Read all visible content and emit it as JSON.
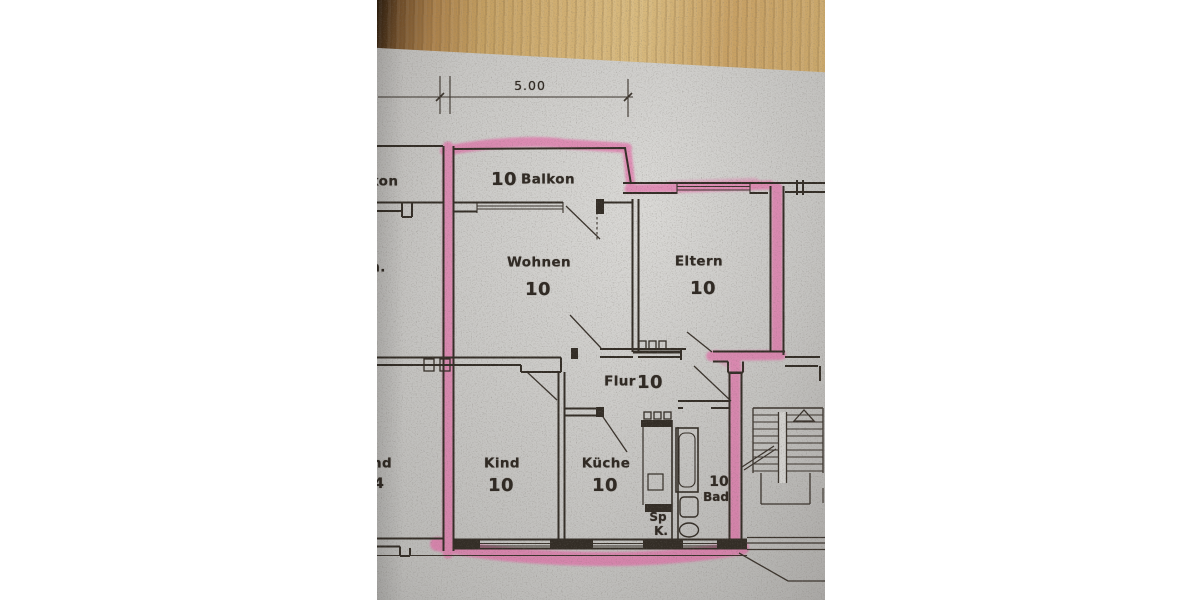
{
  "dimension": {
    "value": "5.00"
  },
  "rooms": {
    "balkon": {
      "label": "Balkon",
      "area": "10"
    },
    "wohnen": {
      "label": "Wohnen",
      "area": "10"
    },
    "eltern": {
      "label": "Eltern",
      "area": "10"
    },
    "flur": {
      "label": "Flur",
      "area": "10"
    },
    "kind": {
      "label": "Kind",
      "area": "10"
    },
    "kueche": {
      "label": "Küche",
      "area": "10"
    },
    "bad": {
      "label": "Bad",
      "area": "10"
    },
    "spk": {
      "line1": "Sp",
      "line2": "K."
    }
  },
  "neighbor": {
    "balkon_partial": "kon",
    "wohnen_partial": "n.",
    "kind_partial": "nd",
    "kind_area_partial": "4"
  },
  "colors": {
    "highlighter": "#e75ba2",
    "ink": "#332d26",
    "paper": "#d3d2cf",
    "wood": "#c9a264"
  }
}
